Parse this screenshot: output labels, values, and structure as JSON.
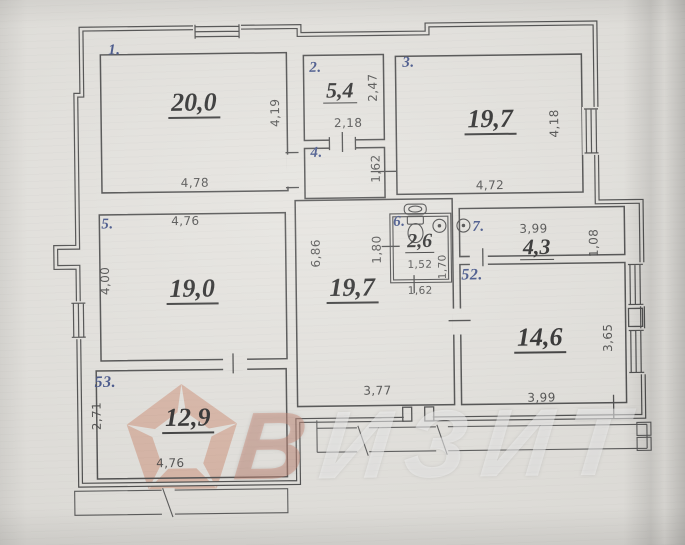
{
  "meta": {
    "type": "scanned apartment floor plan photo",
    "brand": "ВИЗИТ"
  },
  "palette": {
    "paper": "#e2e0db",
    "line": "#3a3a3a",
    "room_number_blue": "#31437e",
    "area_ink": "#1b1b1b",
    "watermark_salmon": "#c97f63",
    "watermark_text": "rgba(255,255,255,0.48)"
  },
  "watermark": {
    "text": "ВИЗИТ",
    "first_letter": "В",
    "rest": "ИЗИТ",
    "logo": "pentagon-logo"
  },
  "rooms": {
    "r1": {
      "num": "1.",
      "area": "20,0",
      "dim_bottom": "4,78",
      "dim_right": "4,19"
    },
    "r2": {
      "num": "2.",
      "area": "5,4",
      "dim_right": "2,47",
      "dim_bottom": "2,18"
    },
    "r3": {
      "num": "3.",
      "area": "19,7",
      "dim_right": "4,18",
      "dim_bottom": "4,72"
    },
    "r4": {
      "num": "4.",
      "dim_right": "1,62"
    },
    "r5": {
      "num": "5.",
      "area": "19,0",
      "dim_top": "4,76",
      "dim_left": "4,00"
    },
    "r6": {
      "num": "6.",
      "area": "2,6",
      "dim_bottom": "1,52",
      "dim_right": "1,70",
      "dim_left": "1,80",
      "dim_below": "1,62"
    },
    "r7": {
      "num": "7.",
      "area": "4,3",
      "dim_top": "3,99",
      "dim_right": "1,08"
    },
    "r52": {
      "num": "52.",
      "area": "14,6",
      "dim_bottom": "3,99",
      "dim_right": "3,65"
    },
    "r53": {
      "num": "53.",
      "area": "12,9",
      "dim_bottom": "4,76",
      "dim_left": "2,71"
    },
    "hall": {
      "area": "19,7",
      "dim_left": "6,86",
      "dim_bottom": "3,77"
    }
  },
  "fixtures": {
    "toilet": "toilet-icon",
    "sink": "sink-icon",
    "washer": "washing-machine-icon",
    "heater": "water-heater-icon"
  }
}
